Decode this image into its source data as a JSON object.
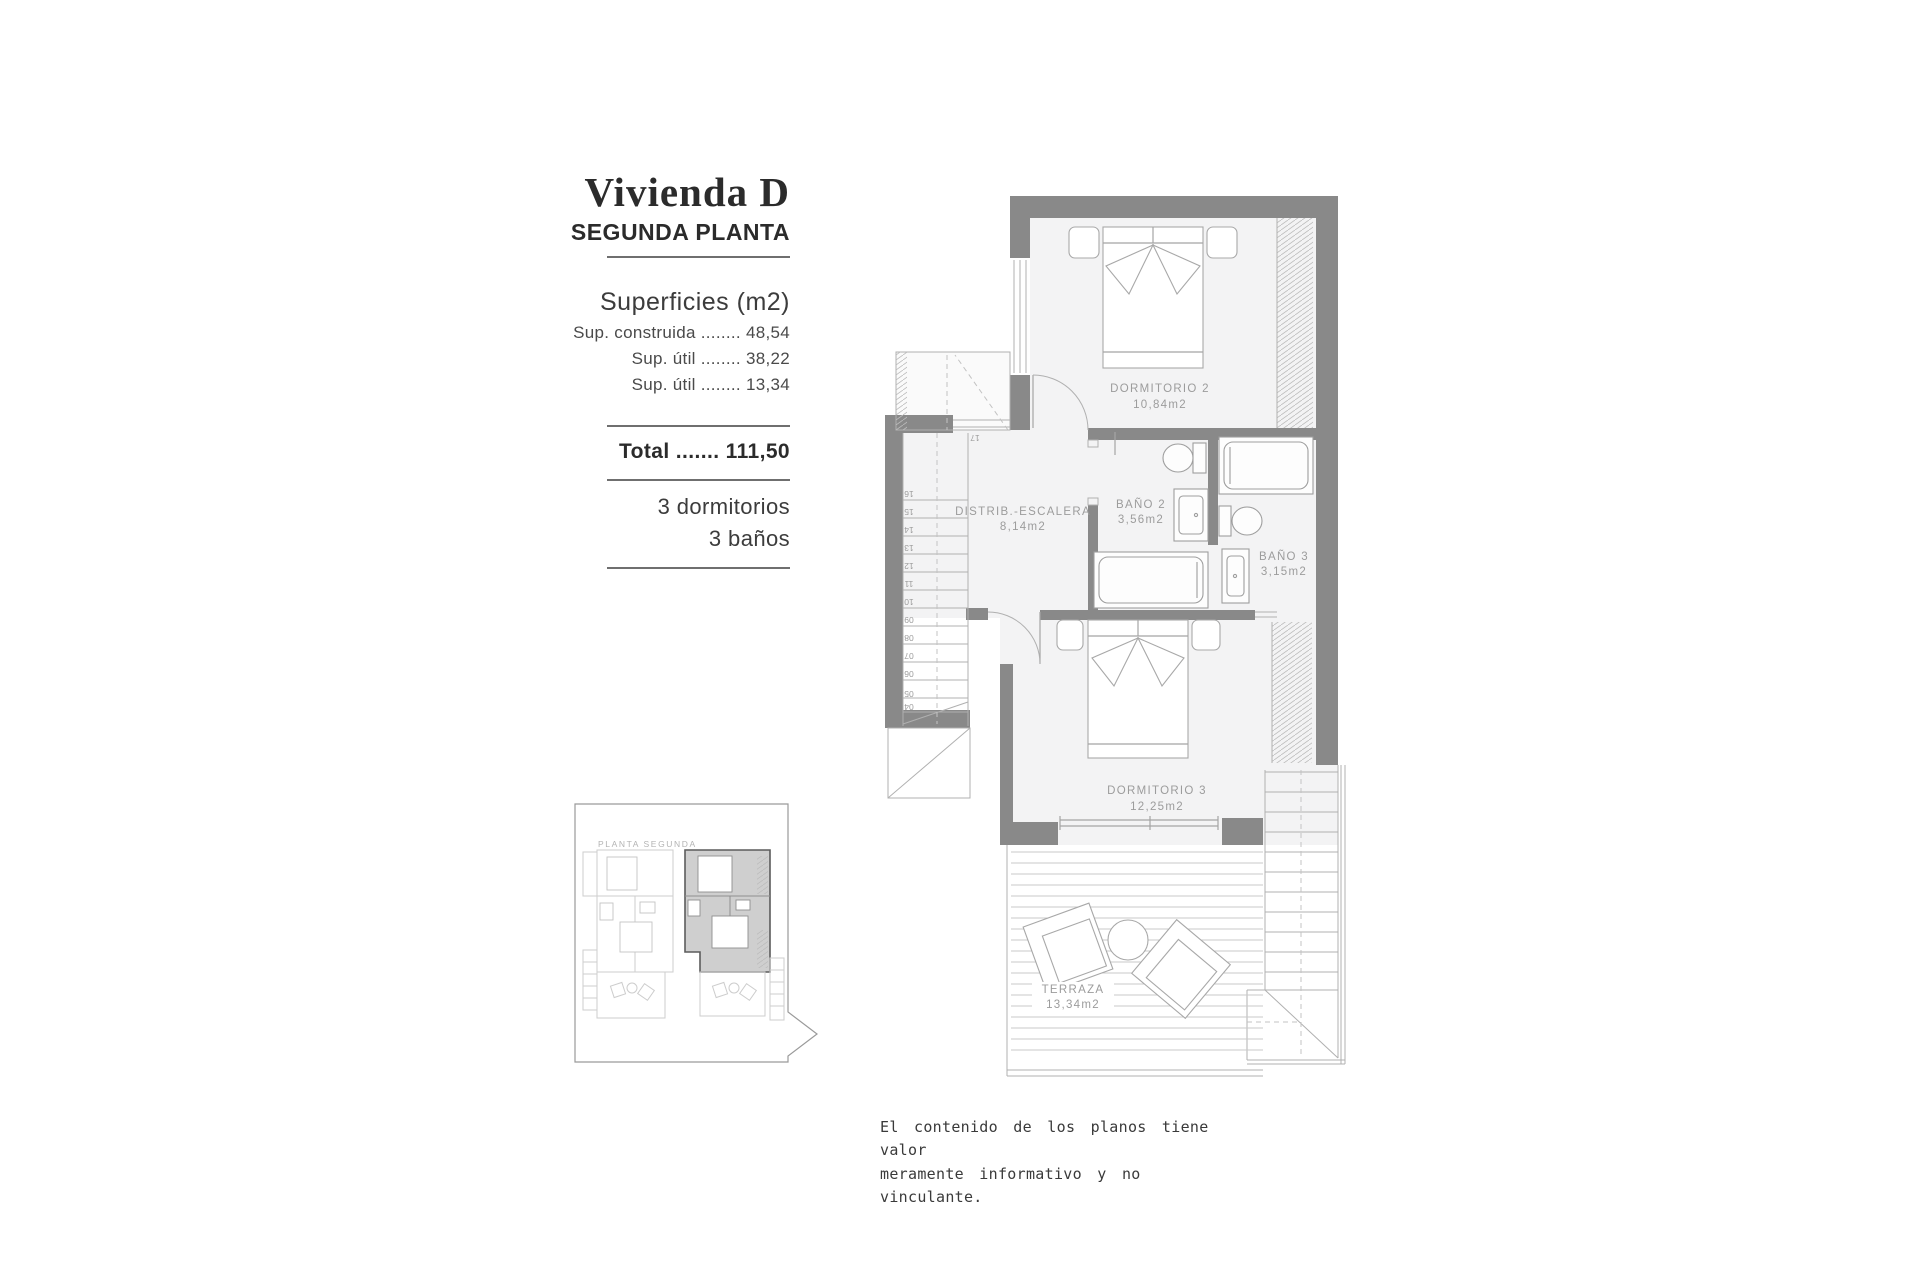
{
  "title_block": {
    "title": "Vivienda D",
    "subtitle": "SEGUNDA PLANTA",
    "superficies_heading": "Superficies (m2)",
    "superficies_lines": [
      "Sup. construida ........ 48,54",
      "Sup. útil ........ 38,22",
      "Sup. útil ........ 13,34"
    ],
    "total_line": "Total ....... 111,50",
    "features": [
      "3 dormitorios",
      "3 baños"
    ]
  },
  "plan": {
    "rooms": [
      {
        "name": "DORMITORIO 2",
        "area": "10,84m2"
      },
      {
        "name": "DISTRIB.-ESCALERA",
        "area": "8,14m2"
      },
      {
        "name": "BAÑO 2",
        "area": "3,56m2"
      },
      {
        "name": "BAÑO 3",
        "area": "3,15m2"
      },
      {
        "name": "DORMITORIO 3",
        "area": "12,25m2"
      },
      {
        "name": "TERRAZA",
        "area": "13,34m2"
      }
    ],
    "stair_top_number": "17",
    "stair_numbers": [
      "16",
      "15",
      "14",
      "13",
      "12",
      "11",
      "10",
      "09",
      "08",
      "07",
      "06",
      "05",
      "04"
    ]
  },
  "key_plan": {
    "label": "PLANTA SEGUNDA"
  },
  "disclaimer": {
    "line1": "El contenido de los planos tiene valor",
    "line2": "meramente informativo y no vinculante."
  },
  "colors": {
    "wall": "#898989",
    "line": "#b0b0b0",
    "label": "#9c9c9c",
    "room_fill": "#f3f3f4"
  }
}
